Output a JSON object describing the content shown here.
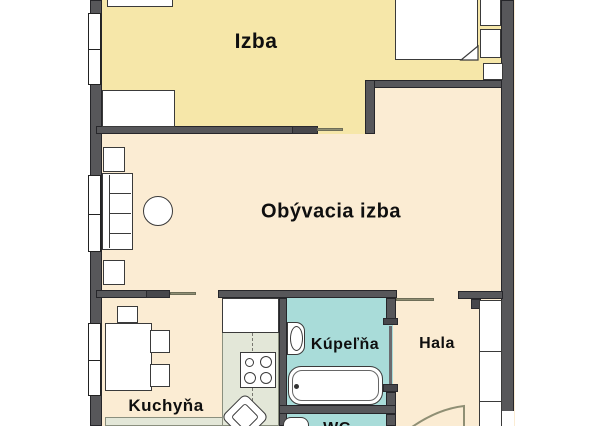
{
  "floorplan": {
    "type": "apartment-floor-plan",
    "rooms": [
      {
        "id": "izba",
        "label": "Izba"
      },
      {
        "id": "obyvacia-izba",
        "label": "Obývacia izba"
      },
      {
        "id": "kuchyna",
        "label": "Kuchyňa"
      },
      {
        "id": "kupelna",
        "label": "Kúpeľňa"
      },
      {
        "id": "hala",
        "label": "Hala"
      },
      {
        "id": "wc",
        "label": "WC"
      }
    ],
    "colors": {
      "wall": "#57575A",
      "room_izba": "#F6E7A9",
      "room_living_kitchen_hall": "#FBECD3",
      "room_bath_wc": "#A9DCD9",
      "kitchen_counter": "#E3E7D8",
      "furniture": "#FFFFFF",
      "door_leaf": "#8F8F74"
    }
  }
}
